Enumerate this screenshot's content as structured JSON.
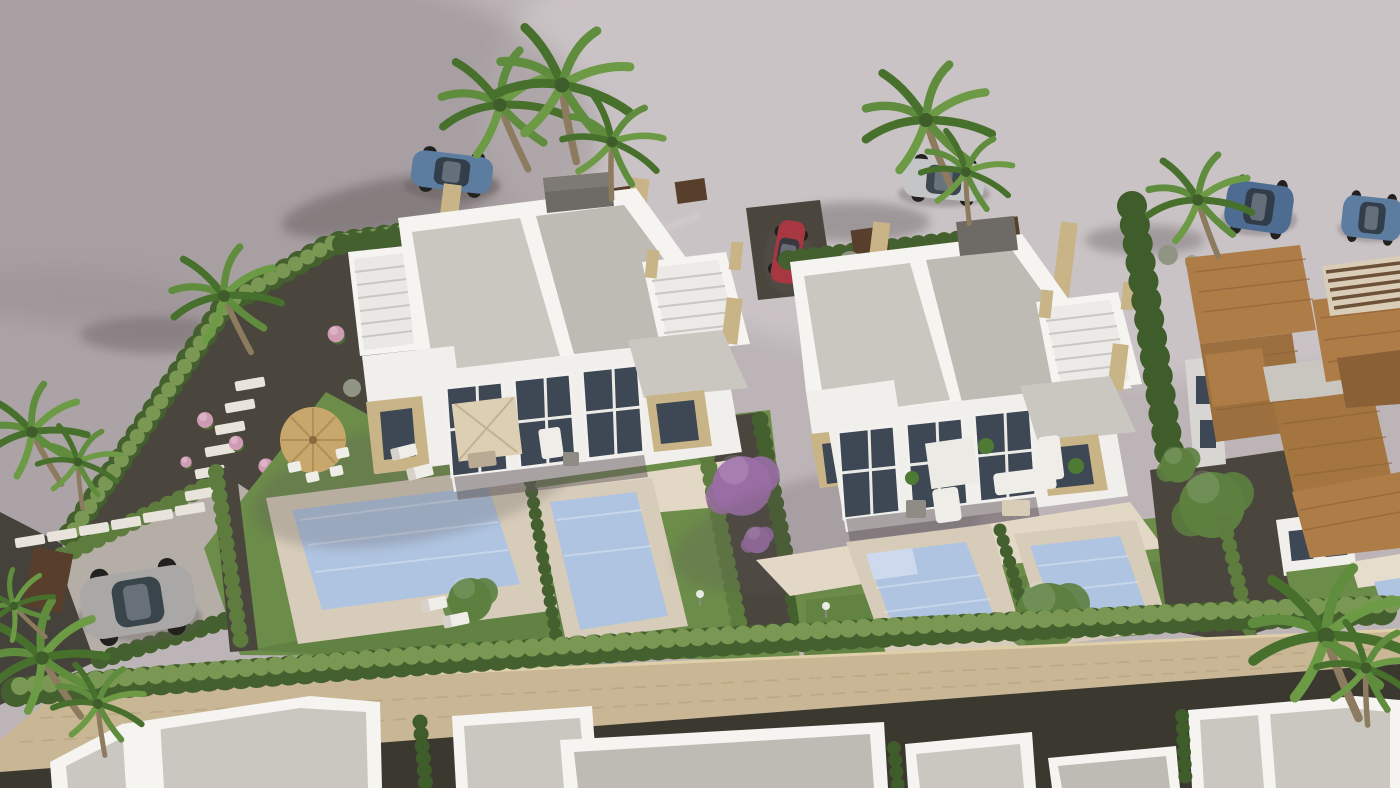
{
  "meta": {
    "title": "Aerial 3D render of new-build villas with private pools",
    "type": "3d-architectural-render",
    "description": "Bird's-eye 3D visualization of a residential development: two pairs of modern white semi-detached villas with flat gravel rooftop solariums, travertine stone accents, glazed double-height facades, landscaped gardens with lawns, cypress hedges, palm trees and private pools; a gravel driveway with a parked grey SUV, cars parked along the back road, existing terracotta tile-roofed houses on the right, a stone perimeter wall with hedge, and a row of white houses under construction along the bottom."
  },
  "palette": {
    "terrain": "#bcb4b6",
    "terrain_light": "#cfc8ca",
    "terrain_shadow": "#948b8e",
    "asphalt": "#45423b",
    "gravel": "#4a463d",
    "driveway": "#b5aea7",
    "grass": "#6c8c4a",
    "grass_dark": "#567739",
    "hedge": "#5d7c3e",
    "hedge_dark": "#44602e",
    "hedge_light": "#7a9853",
    "cypress": "#3f5c2b",
    "pool_water": "#afc4e0",
    "pool_step": "#cdd9ec",
    "deck": "#d7ccb9",
    "terrace": "#e3d8c6",
    "villa_white": "#f1efec",
    "villa_shade": "#d8d6d3",
    "parapet_white": "#f5f4f1",
    "roof_gravel": "#cac7c1",
    "roof_gravel_dark": "#bebbb5",
    "stone_accent": "#c9b488",
    "stone_wall": "#c8b694",
    "glass_dark": "#3e4854",
    "glass_light": "#6b7685",
    "road_dark": "#3b382f",
    "tile_roof": "#ae7c47",
    "tile_dark": "#8a6136",
    "pergola_wood": "#6d5038",
    "fence_brown": "#573f2b",
    "trunk": "#8c7b5f",
    "palm_green": "#5f8c3d",
    "palm_dark": "#47702d",
    "tree_green": "#5d8040",
    "flower_pink": "#cf9ab4",
    "flower_purple": "#9a6da5",
    "car_sports_blue": "#5d7da0",
    "car_silver": "#c3c5c6",
    "car_red": "#a73741",
    "car_suv_blue": "#4e6b92",
    "car_suv_gray": "#a9a8a6",
    "car_glass": "#2e3841",
    "furniture_white": "#efede8",
    "parasol_straw": "#c7a76c",
    "parasol_canvas": "#dccfb4",
    "chimney_gray": "#6e6a66",
    "lamp_white": "#ecebe8",
    "shadow": "#5f5659"
  },
  "scene": {
    "buildings": [
      "semi-detached villa pair (left) with rooftop solarium and two pools",
      "semi-detached villa pair (right) with rooftop solarium and two pools",
      "existing tile-roofed houses (right side)",
      "row of white flat-roofed houses under construction (bottom)"
    ],
    "vehicles": [
      {
        "label": "blue sports car, back road left",
        "color_key": "car_sports_blue"
      },
      {
        "label": "silver car behind palms, back road centre",
        "color_key": "car_silver"
      },
      {
        "label": "red compact car parked by right villa",
        "color_key": "car_red"
      },
      {
        "label": "dark blue SUV, back road right",
        "color_key": "car_suv_blue"
      },
      {
        "label": "blue car, far right road edge",
        "color_key": "car_sports_blue"
      },
      {
        "label": "grey SUV in left driveway",
        "color_key": "car_suv_gray"
      }
    ],
    "water_features": [
      "left villa pool",
      "left villa second pool",
      "right villa pool with steps",
      "right villa second pool",
      "neighbour pool corner far right"
    ],
    "vegetation": [
      "fan palm trees",
      "cypress hedge rows",
      "bougainvillea tree",
      "pink flowering shrubs",
      "banana plant",
      "lawn panels",
      "perimeter hedge"
    ],
    "hardscape": [
      "stone perimeter wall",
      "dark gravel paths",
      "white stepping stones",
      "beige pool decks",
      "tiled terraces",
      "driveway with timber gate"
    ],
    "furniture": [
      "straw parasol with dining set",
      "canvas parasol with dining table",
      "white lounge sofas",
      "sun loungers",
      "garden lamps"
    ]
  }
}
